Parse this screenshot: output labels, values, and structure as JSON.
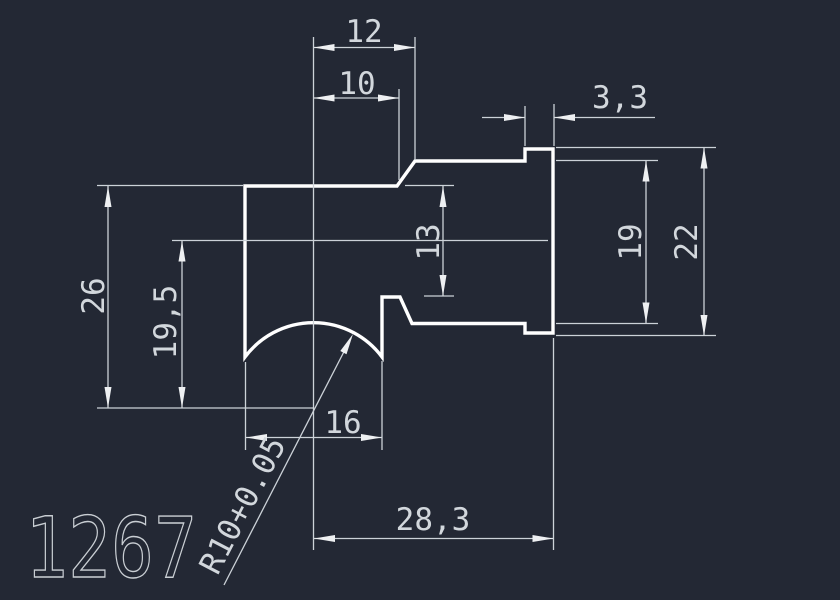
{
  "drawing": {
    "part_number": "1267",
    "dims": {
      "top_width": "12",
      "top_width_inner": "10",
      "flange_thickness": "3,3",
      "overall_height": "26",
      "center_height": "19,5",
      "step_height": "13",
      "boss_diameter": "19",
      "flange_diameter": "22",
      "bottom_width": "16",
      "overall_length": "28,3",
      "arc_radius": "R10+0.05"
    },
    "colors": {
      "background": "#232834",
      "part_outline": "#ffffff",
      "dimension_lines": "#ccd2d8",
      "dimension_text": "#d2d7dc",
      "part_number_text": "#c9ced3"
    }
  }
}
